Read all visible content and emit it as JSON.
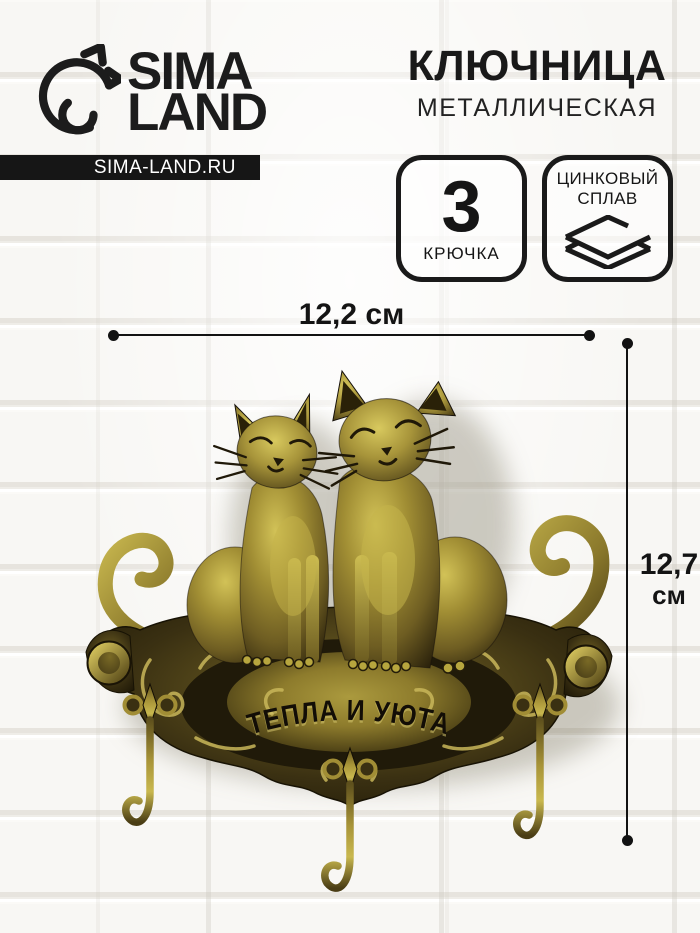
{
  "brand": {
    "line1": "SIMA",
    "line2": "LAND",
    "site": "SIMA-LAND.RU",
    "logo_icon": "dolphin-icon"
  },
  "title": {
    "main": "КЛЮЧНИЦА",
    "sub": "МЕТАЛЛИЧЕСКАЯ"
  },
  "features": {
    "hooks": {
      "value": "3",
      "label": "КРЮЧКА"
    },
    "material": {
      "line1": "ЦИНКОВЫЙ",
      "line2": "СПЛАВ",
      "icon": "layers-icon"
    }
  },
  "dimensions": {
    "width": "12,2 см",
    "height_value": "12,7",
    "height_unit": "см"
  },
  "product": {
    "engraving": "ТЕПЛА И УЮТА",
    "hooks_count": 3,
    "cats_count": 2
  },
  "colors": {
    "ink": "#1a1a1a",
    "bar_bg": "#161616",
    "wall": "#f6f5f2",
    "brass_light": "#d2c257",
    "brass_mid": "#9d8b33",
    "brass_dark": "#2c230c"
  }
}
